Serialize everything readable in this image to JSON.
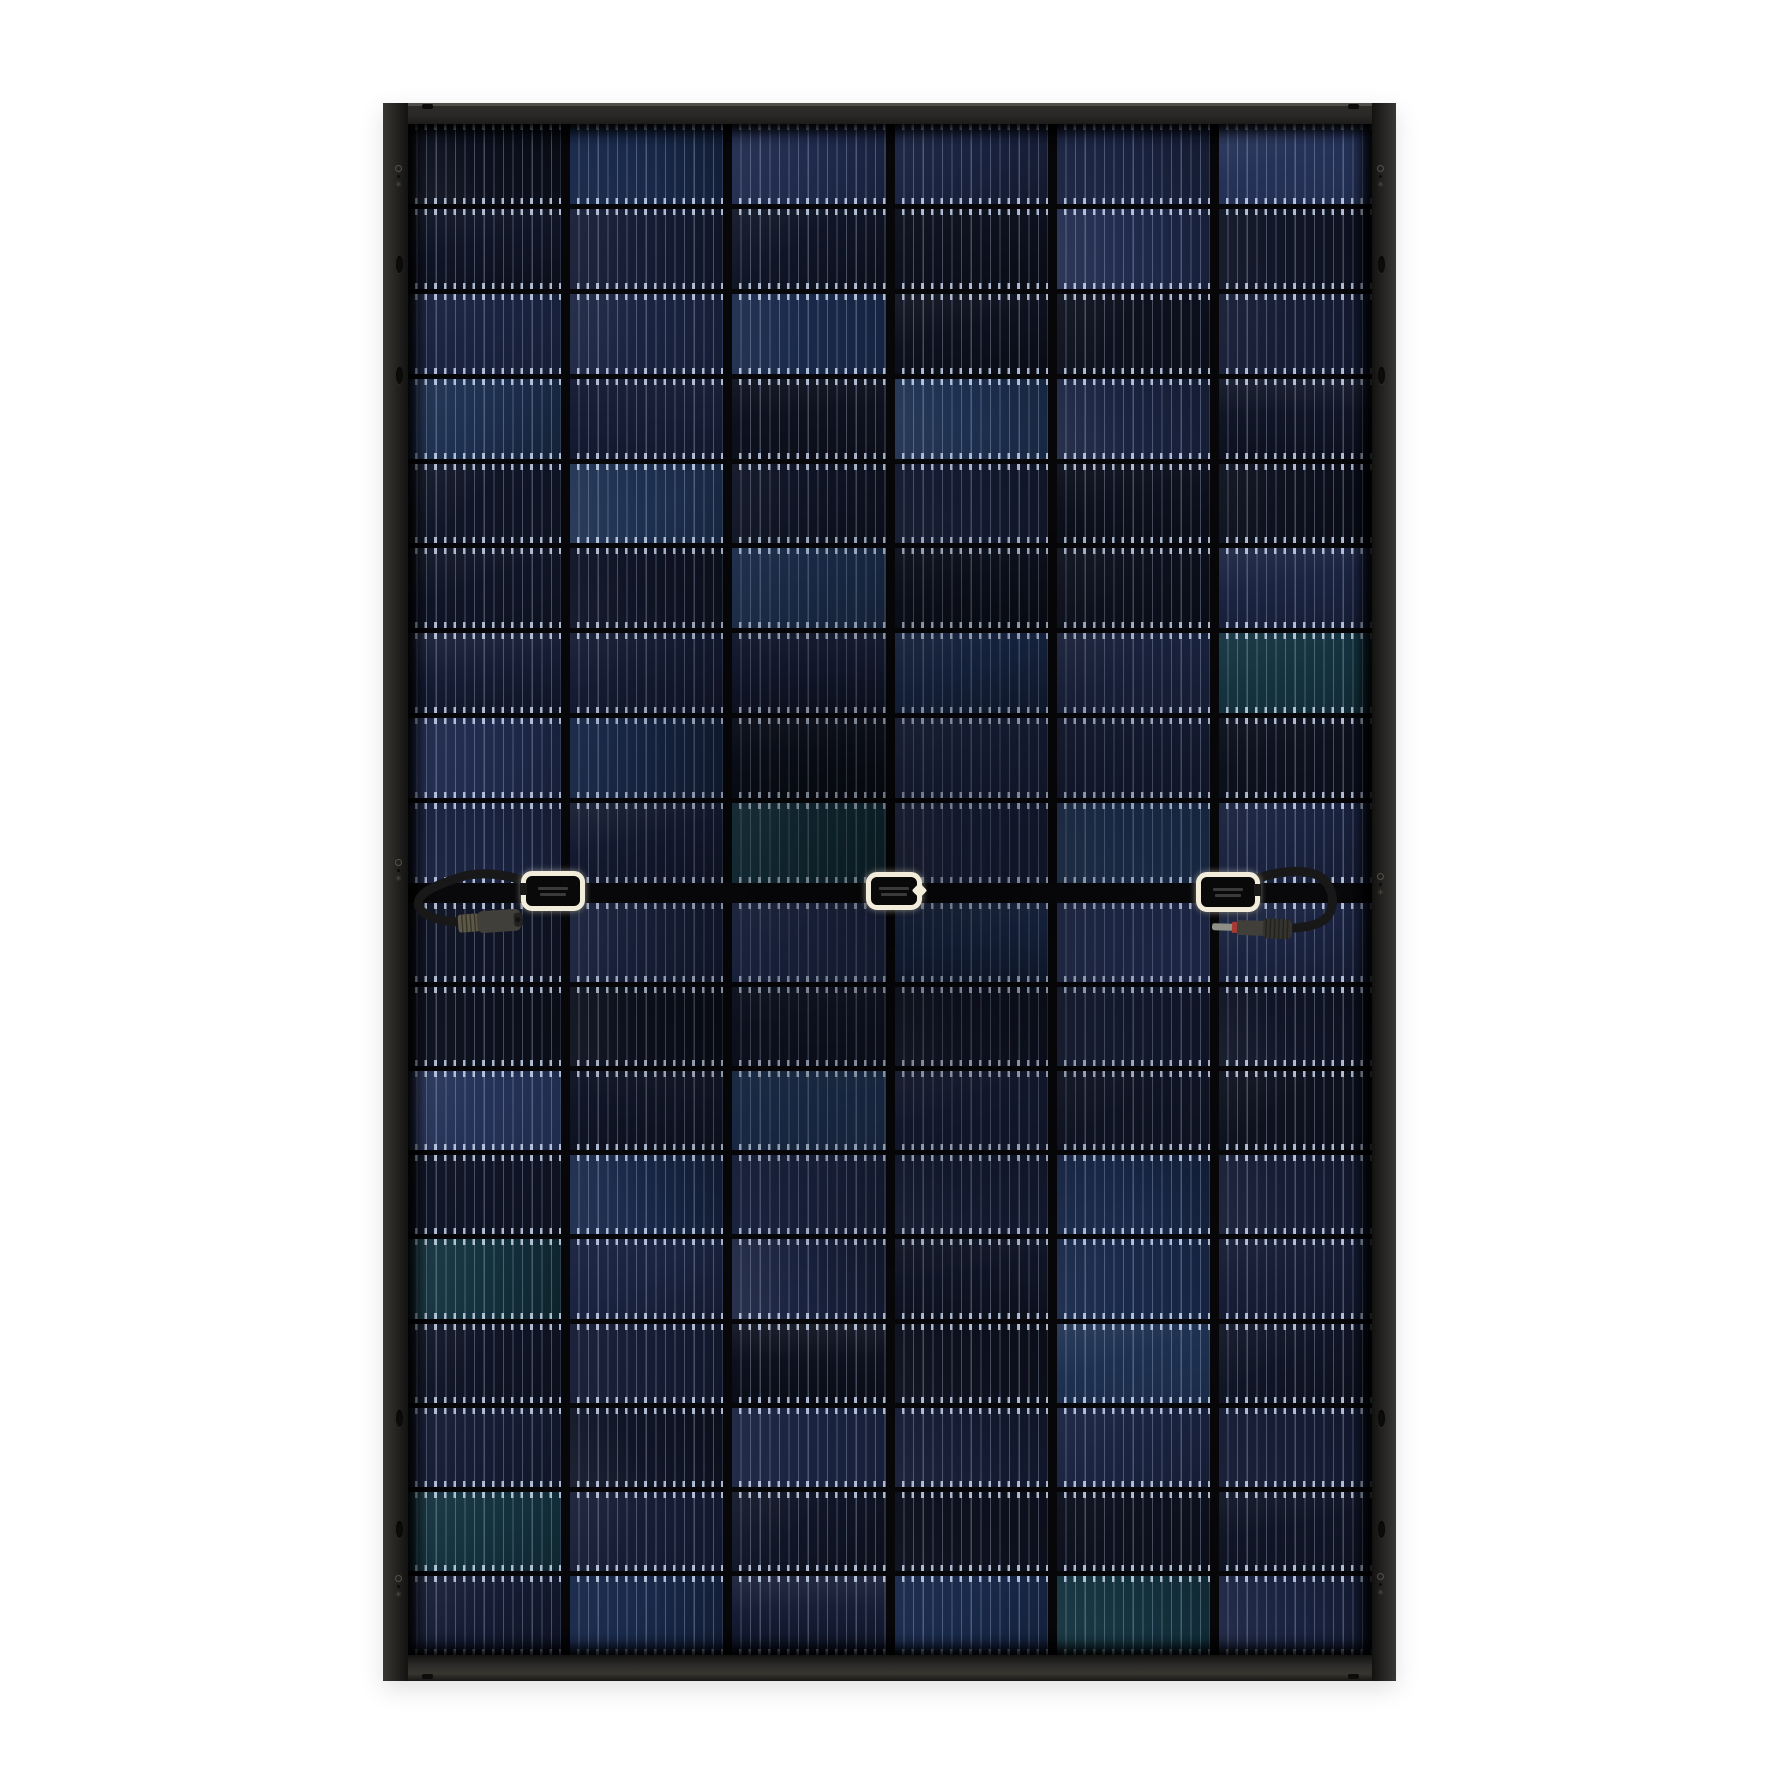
{
  "page": {
    "background_color": "#ffffff",
    "width": 1782,
    "height": 1783
  },
  "panel": {
    "alt": "rear view of a black-framed solar photovoltaic module with three junction boxes and two cables",
    "geometry": {
      "left": 383,
      "top": 103,
      "width": 1013,
      "height": 1578,
      "frame_top": 21,
      "frame_left": 25,
      "frame_right": 24,
      "frame_bottom": 26,
      "center_band_y": 883,
      "center_band_height": 20,
      "top_half_height": 759,
      "bottom_half_height": 752
    },
    "frame": {
      "base_color": "#232220",
      "highlight_color": "#504d48",
      "hole_color": "#0c0c0b",
      "mark_color": "#55524c"
    },
    "grid": {
      "columns": 6,
      "rows_per_half": 9,
      "row_gap_px": 5,
      "column_gap_px": 9,
      "gap_color": "#07070a",
      "busbar_period_px": 9.6,
      "busbar_color": "rgba(185,200,228,0.32)",
      "pad_color": "rgba(212,225,248,0.78)",
      "cell_palette": [
        {
          "color": "#1a2340",
          "weight": 3
        },
        {
          "color": "#151c34",
          "weight": 4
        },
        {
          "color": "#101526",
          "weight": 4
        },
        {
          "color": "#0d111e",
          "weight": 3
        },
        {
          "color": "#202b4e",
          "weight": 2
        },
        {
          "color": "#19294a",
          "weight": 2
        },
        {
          "color": "#253258",
          "weight": 1
        },
        {
          "color": "#14333f",
          "weight": 1
        },
        {
          "color": "#1d3050",
          "weight": 1
        }
      ]
    },
    "junction_boxes": [
      {
        "id": "left",
        "x": 521,
        "y": 871,
        "width": 64,
        "height": 40,
        "cable_side": "left"
      },
      {
        "id": "center",
        "x": 866,
        "y": 872,
        "width": 56,
        "height": 38,
        "cable_side": "none",
        "tab_side": "right"
      },
      {
        "id": "right",
        "x": 1196,
        "y": 872,
        "width": 64,
        "height": 40,
        "cable_side": "right"
      }
    ],
    "junction_box_colors": {
      "border": "#f2ecdb",
      "body": "#090909",
      "marking": "rgba(255,255,255,0.2)"
    },
    "cables": {
      "color": "#181818",
      "width_px": 9,
      "paths": [
        {
          "id": "left-cable",
          "d": "M 527 882 C 506 874 480 871 461 877 C 442 883 423 890 419 900 C 415 910 428 918 447 921 L 459 922"
        },
        {
          "id": "right-cable",
          "d": "M 1251 881 C 1280 869 1311 868 1323 879 C 1334 889 1335 905 1328 916 C 1322 924 1309 927 1294 928"
        }
      ]
    },
    "connectors": [
      {
        "id": "left-connector",
        "style": "female",
        "x": 458,
        "y": 921,
        "angle": -4
      },
      {
        "id": "right-connector",
        "style": "male",
        "x": 1212,
        "y": 928,
        "angle": 2
      }
    ],
    "connector_colors": {
      "collar": "#5e5847",
      "body": "#403f3a",
      "cap": "#232220",
      "tip": "#8f8f87",
      "ring": "#a83a33",
      "knurl": "#34332d",
      "rib": "#1d1c19",
      "hole": "#121210"
    },
    "frame_marks": [
      {
        "type": "ground",
        "x": 399,
        "y": 178
      },
      {
        "type": "oval",
        "x": 399,
        "y": 264
      },
      {
        "type": "oval",
        "x": 399,
        "y": 375
      },
      {
        "type": "ground",
        "x": 399,
        "y": 872
      },
      {
        "type": "oval",
        "x": 399,
        "y": 1418
      },
      {
        "type": "oval",
        "x": 399,
        "y": 1529
      },
      {
        "type": "ground",
        "x": 399,
        "y": 1588
      },
      {
        "type": "ground",
        "x": 1381,
        "y": 178
      },
      {
        "type": "oval",
        "x": 1381,
        "y": 264
      },
      {
        "type": "oval",
        "x": 1381,
        "y": 375
      },
      {
        "type": "ground",
        "x": 1381,
        "y": 886
      },
      {
        "type": "oval",
        "x": 1381,
        "y": 1418
      },
      {
        "type": "oval",
        "x": 1381,
        "y": 1529
      },
      {
        "type": "ground",
        "x": 1381,
        "y": 1586
      },
      {
        "type": "slot",
        "x": 427,
        "y": 106
      },
      {
        "type": "slot",
        "x": 1353,
        "y": 106
      },
      {
        "type": "slot",
        "x": 427,
        "y": 1676
      },
      {
        "type": "slot",
        "x": 1353,
        "y": 1676
      }
    ]
  }
}
